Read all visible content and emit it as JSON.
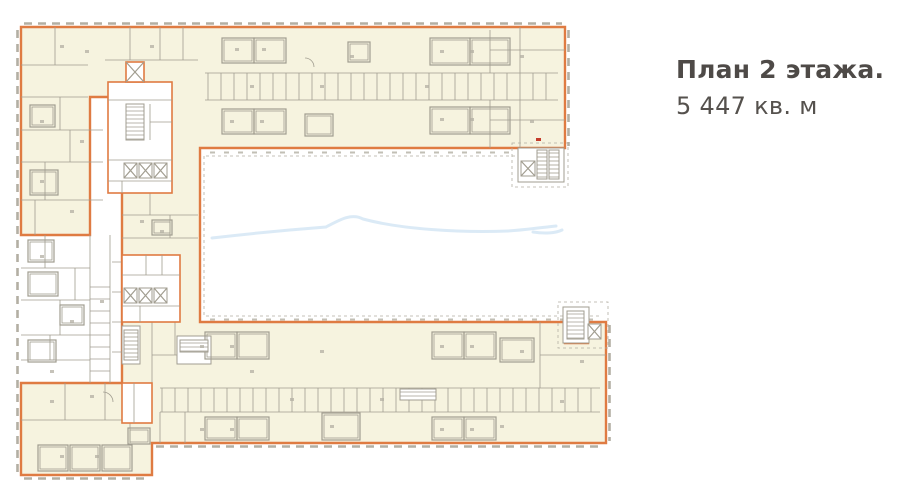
{
  "plan": {
    "heading": "План 2 этажа.",
    "area_label": "5 447 кв. м"
  },
  "colors": {
    "leasable-fill": "#f6f3df",
    "outline-orange": "#df7b42",
    "wall-gray": "#a19d90",
    "tick-gray": "#b3afa3",
    "watermark-blue": "#d9e9f6",
    "heading-color": "#4e4a47",
    "subheading-color": "#55514d"
  }
}
